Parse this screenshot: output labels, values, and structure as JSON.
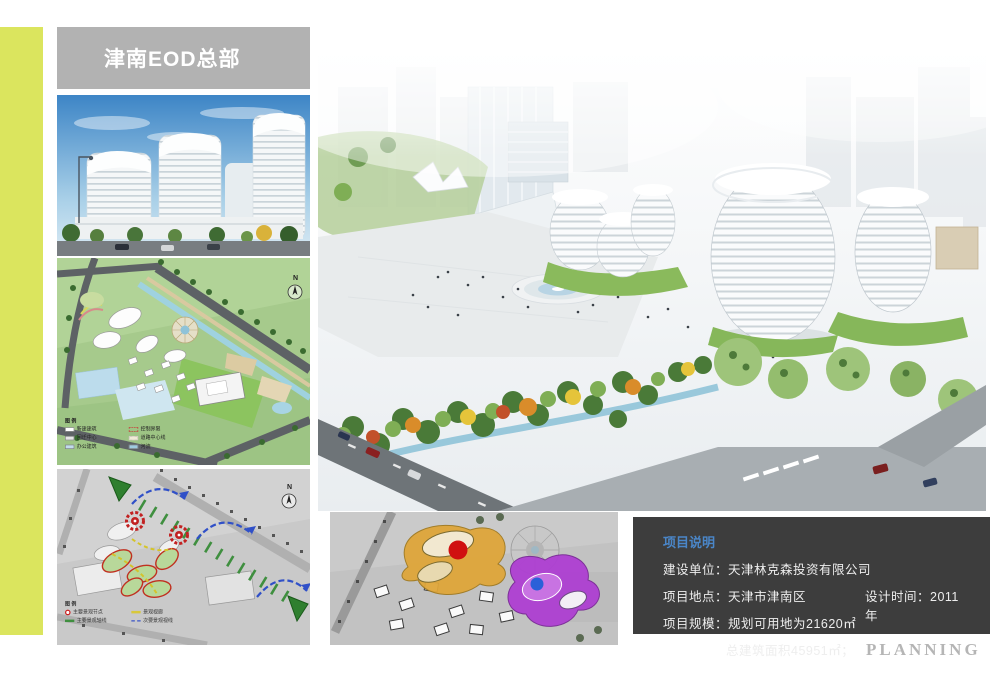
{
  "page": {
    "title": "津南EOD总部",
    "footer": "PLANNING"
  },
  "colors": {
    "accent_bar": "#dbe55e",
    "title_bar": "#b2b2b2",
    "info_box_bg": "#3d3d3d",
    "info_title_blue": "#4a86c8",
    "planning_gray": "#b5b5b5"
  },
  "north_label": "N",
  "master_plan_legend": {
    "title": "图 例",
    "items": [
      {
        "label": "新建建筑",
        "color": "#ffffff"
      },
      {
        "label": "控制界限",
        "color": "#cc3333"
      },
      {
        "label": "回迁中心",
        "color": "#e4e4e4"
      },
      {
        "label": "道路中心线",
        "color": "#f0ead6"
      },
      {
        "label": "办公建筑",
        "color": "#c2dcec"
      },
      {
        "label": "河流",
        "color": "#9fcbe0"
      }
    ]
  },
  "analysis_legend": {
    "title": "图 例",
    "items": [
      {
        "label": "主要景观节点",
        "color": "#cc2222"
      },
      {
        "label": "景观视廊",
        "color": "#d8c83a"
      },
      {
        "label": "主要景观轴线",
        "color": "#3f8f3f"
      },
      {
        "label": "次要景观视线",
        "color": "#3a55c8"
      }
    ]
  },
  "info_box": {
    "title": "项目说明",
    "line1": "建设单位：天津林克森投资有限公司",
    "line2_left": "项目地点：天津市津南区",
    "line2_right": "设计时间：2011年",
    "line3": "项目规模：规划可用地为21620㎡",
    "line4": "总建筑面积45951㎡；"
  }
}
